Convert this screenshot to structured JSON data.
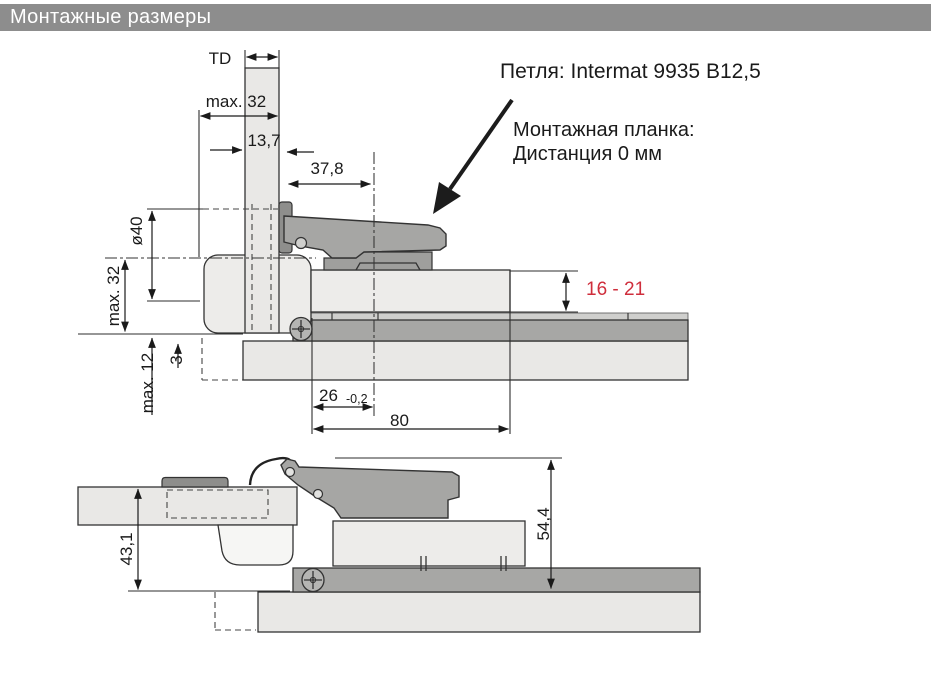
{
  "title_bar": {
    "label": "Монтажные размеры"
  },
  "callout": {
    "hinge_label": "Петля: Intermat 9935 B12,5",
    "plate_label_line1": "Монтажная планка:",
    "plate_label_line2": "Дистанция 0 мм"
  },
  "top_view": {
    "door_thickness": "TD",
    "max_drilling_distance": "max. 32",
    "cup_edge_distance": "13,7",
    "arm_projection": "37,8",
    "cup_diameter": "ø40",
    "max_overlay": "max. 32",
    "max_gap_bottom": "max. 12",
    "reveal_gap": "3",
    "mounting_height_range": "16 - 21",
    "drilling_distance": "26",
    "drilling_tolerance": "-0,2",
    "plate_length": "80"
  },
  "side_view": {
    "door_clearance": "43,1",
    "overall_height": "54,4"
  },
  "colors": {
    "title_bar_bg": "#8d8d8d",
    "title_bar_fg": "#ffffff",
    "highlight_red": "#cf2e3c",
    "panel_light": "#e9e8e6",
    "panel_mid": "#a7a7a5",
    "metal_gray": "#a6a6a4",
    "outline": "#333333"
  }
}
